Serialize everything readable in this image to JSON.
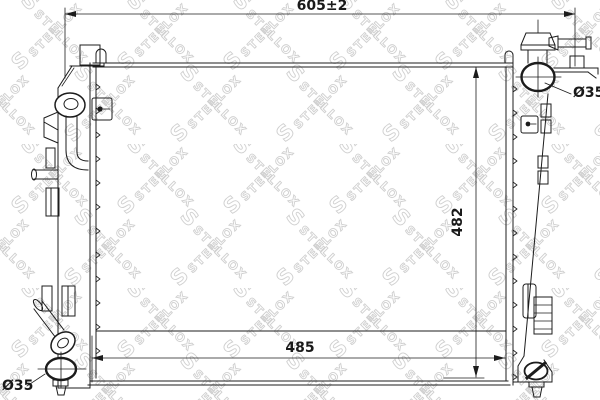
{
  "drawing": {
    "background": "#ffffff",
    "line_color": "#1c1c1c",
    "dimensions": {
      "overall_width": "605±2",
      "core_height": "482",
      "core_width": "485",
      "port_top_right": "Ø35",
      "port_bottom_left": "Ø35"
    },
    "watermark": {
      "logo_letter": "S",
      "brand": "STELLOX",
      "color": "#d0d0d0"
    }
  }
}
